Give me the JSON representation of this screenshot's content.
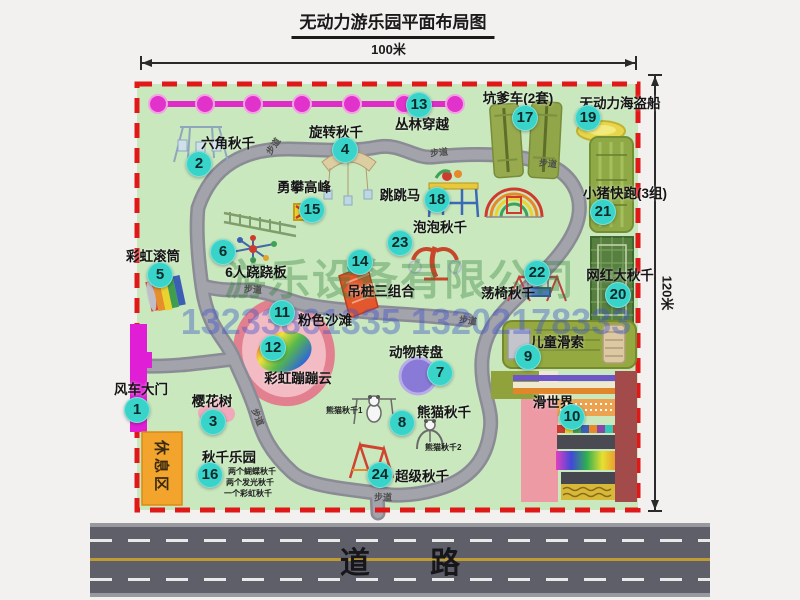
{
  "title": "无动力游乐园平面布局图",
  "dimensions": {
    "width_label": "100米",
    "height_label": "120米"
  },
  "road_label": "道 路",
  "walkway_label": "步道",
  "rest_area_label": "休息区",
  "watermark": {
    "company": "游乐设备有限公司",
    "phone": "13233861335 13202178333"
  },
  "attractions": [
    {
      "num": "1",
      "name": "风车大门"
    },
    {
      "num": "2",
      "name": "六角秋千"
    },
    {
      "num": "3",
      "name": "樱花树"
    },
    {
      "num": "4",
      "name": "旋转秋千"
    },
    {
      "num": "5",
      "name": "彩虹滚筒"
    },
    {
      "num": "6",
      "name": "6人跷跷板"
    },
    {
      "num": "7",
      "name": "动物转盘"
    },
    {
      "num": "8",
      "name": "熊猫秋千"
    },
    {
      "num": "9",
      "name": "儿童滑索"
    },
    {
      "num": "10",
      "name": "滑世界"
    },
    {
      "num": "11",
      "name": "粉色沙滩"
    },
    {
      "num": "12",
      "name": "彩虹蹦蹦云"
    },
    {
      "num": "13",
      "name": "丛林穿越"
    },
    {
      "num": "14",
      "name": "吊桩三组合"
    },
    {
      "num": "15",
      "name": "勇攀高峰"
    },
    {
      "num": "16",
      "name": "秋千乐园"
    },
    {
      "num": "17",
      "name": "坑爹车(2套)"
    },
    {
      "num": "18",
      "name": "跳跳马"
    },
    {
      "num": "19",
      "name": "无动力海盗船"
    },
    {
      "num": "20",
      "name": "网红大秋千"
    },
    {
      "num": "21",
      "name": "小猪快跑(3组)"
    },
    {
      "num": "22",
      "name": "荡椅秋千"
    },
    {
      "num": "23",
      "name": "泡泡秋千"
    },
    {
      "num": "24",
      "name": "超级秋千"
    }
  ],
  "swing_park_notes": [
    "两个蝴蝶秋千",
    "两个发光秋千",
    "一个彩虹秋千"
  ],
  "panda_swing_notes": [
    "熊猫秋千1",
    "熊猫秋千2"
  ],
  "colors": {
    "park_green": "#c9e8be",
    "path_gray": "#9c9ca5",
    "boundary_red": "#e01818",
    "badge_teal": "#38d3c9",
    "chain_magenta": "#e232cc",
    "gate_magenta": "#e01ed6",
    "rest_area_orange": "#f3a42c",
    "road_gray": "#5f5f6a"
  }
}
